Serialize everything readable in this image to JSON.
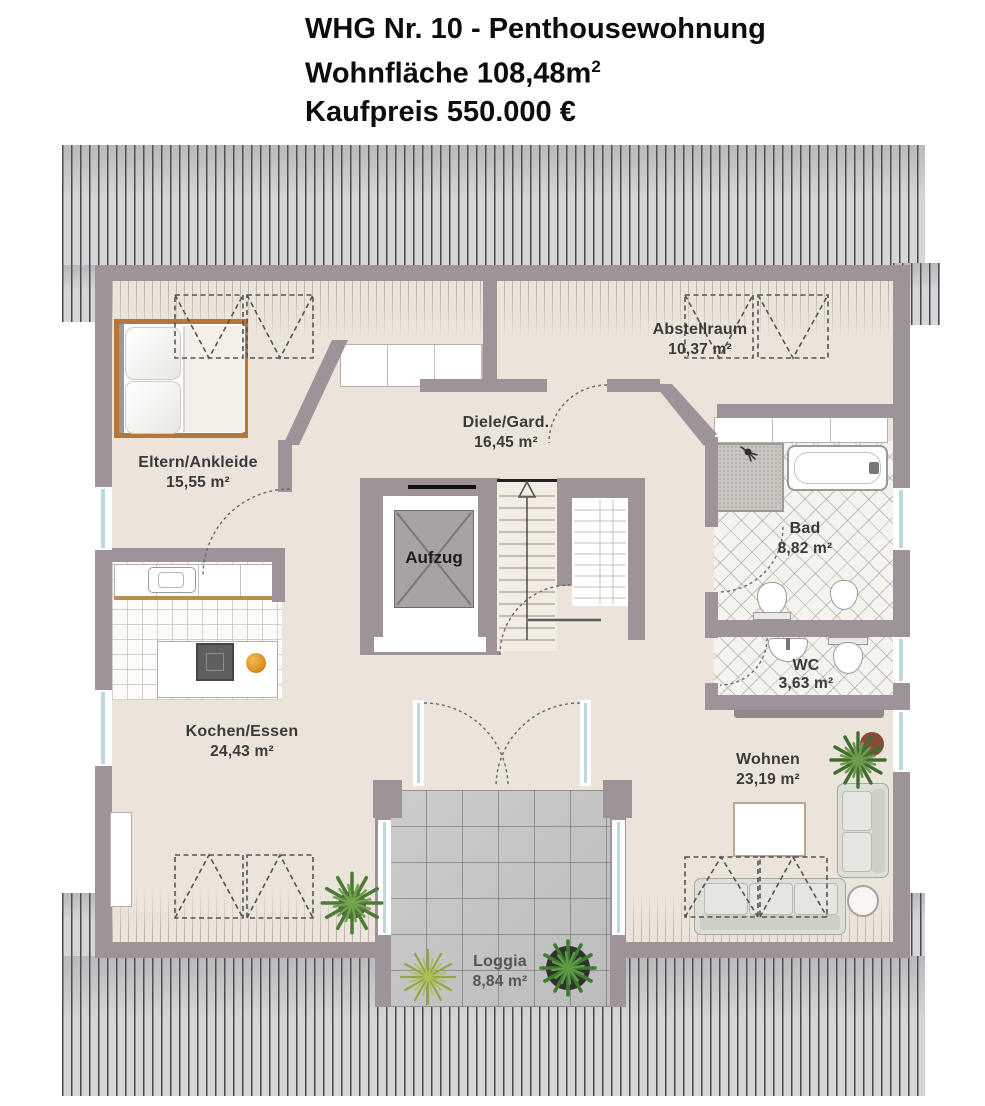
{
  "title": {
    "line1": "WHG Nr. 10 - Penthousewohnung",
    "line2_text": "Wohnfläche 108,48m",
    "line2_sup": "2",
    "line3": "Kaufpreis 550.000 €"
  },
  "rooms": {
    "eltern": {
      "name": "Eltern/Ankleide",
      "area": "15,55 m²"
    },
    "diele": {
      "name": "Diele/Gard.",
      "area": "16,45 m²"
    },
    "abstellraum": {
      "name": "Abstellraum",
      "area": "10,37 m²"
    },
    "bad": {
      "name": "Bad",
      "area": "8,82 m²"
    },
    "wc": {
      "name": "WC",
      "area": "3,63 m²"
    },
    "wohnen": {
      "name": "Wohnen",
      "area": "23,19 m²"
    },
    "kochen": {
      "name": "Kochen/Essen",
      "area": "24,43 m²"
    },
    "loggia": {
      "name": "Loggia",
      "area": "8,84 m²"
    },
    "aufzug": {
      "name": "Aufzug"
    }
  },
  "colors": {
    "wall": "#9d9398",
    "floor": "#ebe4db",
    "roof_stripe_dark": "#46464b",
    "roof_stripe_light": "#d6d6d8",
    "wood": "#b5773c",
    "window_glass": "#bcd9de",
    "sofa": "#dcded7",
    "loggia_tile": "#c6c6c6",
    "bath_tile": "#f5f3ee"
  }
}
